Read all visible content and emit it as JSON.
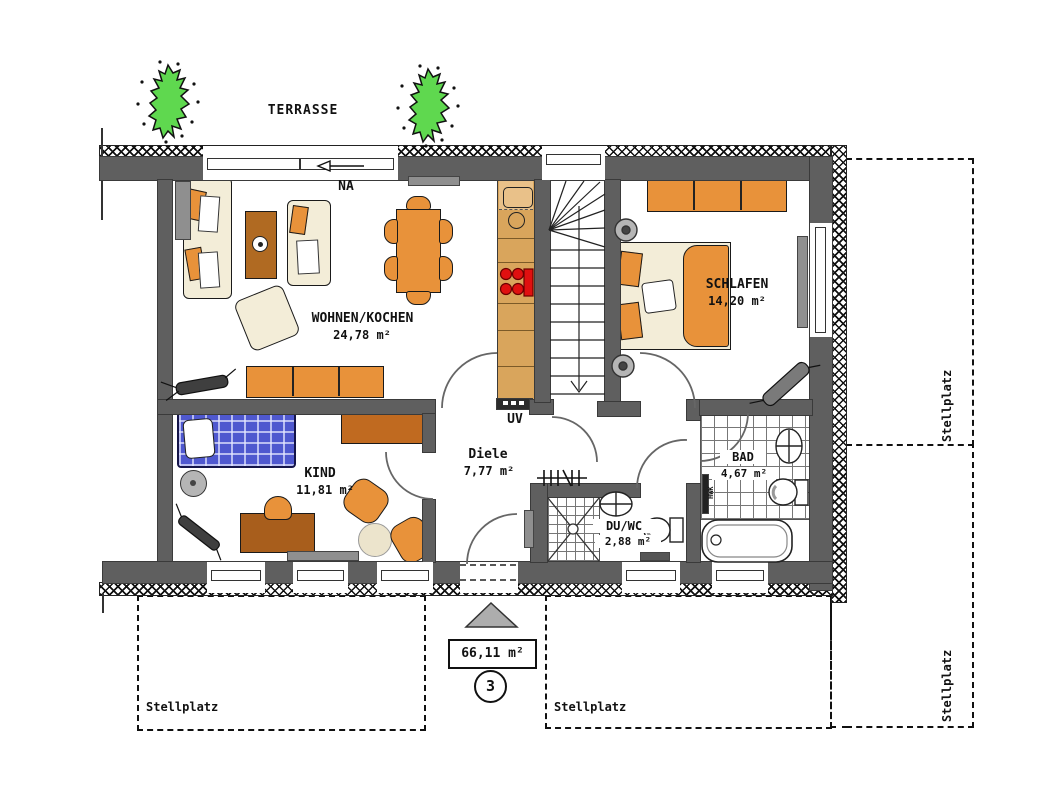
{
  "labels": {
    "terrasse": "TERRASSE",
    "na": "NA",
    "uv": "UV",
    "hwk": "HWK",
    "stellplatz": "Stellplatz"
  },
  "rooms": {
    "wohnen": {
      "name": "WOHNEN/KOCHEN",
      "area": "24,78 m²"
    },
    "schlafen": {
      "name": "SCHLAFEN",
      "area": "14,20 m²"
    },
    "kind": {
      "name": "KIND",
      "area": "11,81 m²"
    },
    "diele": {
      "name": "Diele",
      "area": "7,77 m²"
    },
    "duwc": {
      "name": "DU/WC",
      "area": "2,88 m²"
    },
    "bad": {
      "name": "BAD",
      "area": "4,67 m²"
    }
  },
  "summary": {
    "total_area": "66,11 m²",
    "unit_number": "3"
  },
  "colors": {
    "wall_gray": "#5f5f5f",
    "furniture_orange": "#e8923a",
    "wood_brown": "#b06a22",
    "counter_tan": "#d9a55c",
    "bed_blue": "#4f58cf",
    "plant_green": "#5fd84f",
    "radiator_gray": "#8f8f8f",
    "burner_red": "#e01010"
  }
}
